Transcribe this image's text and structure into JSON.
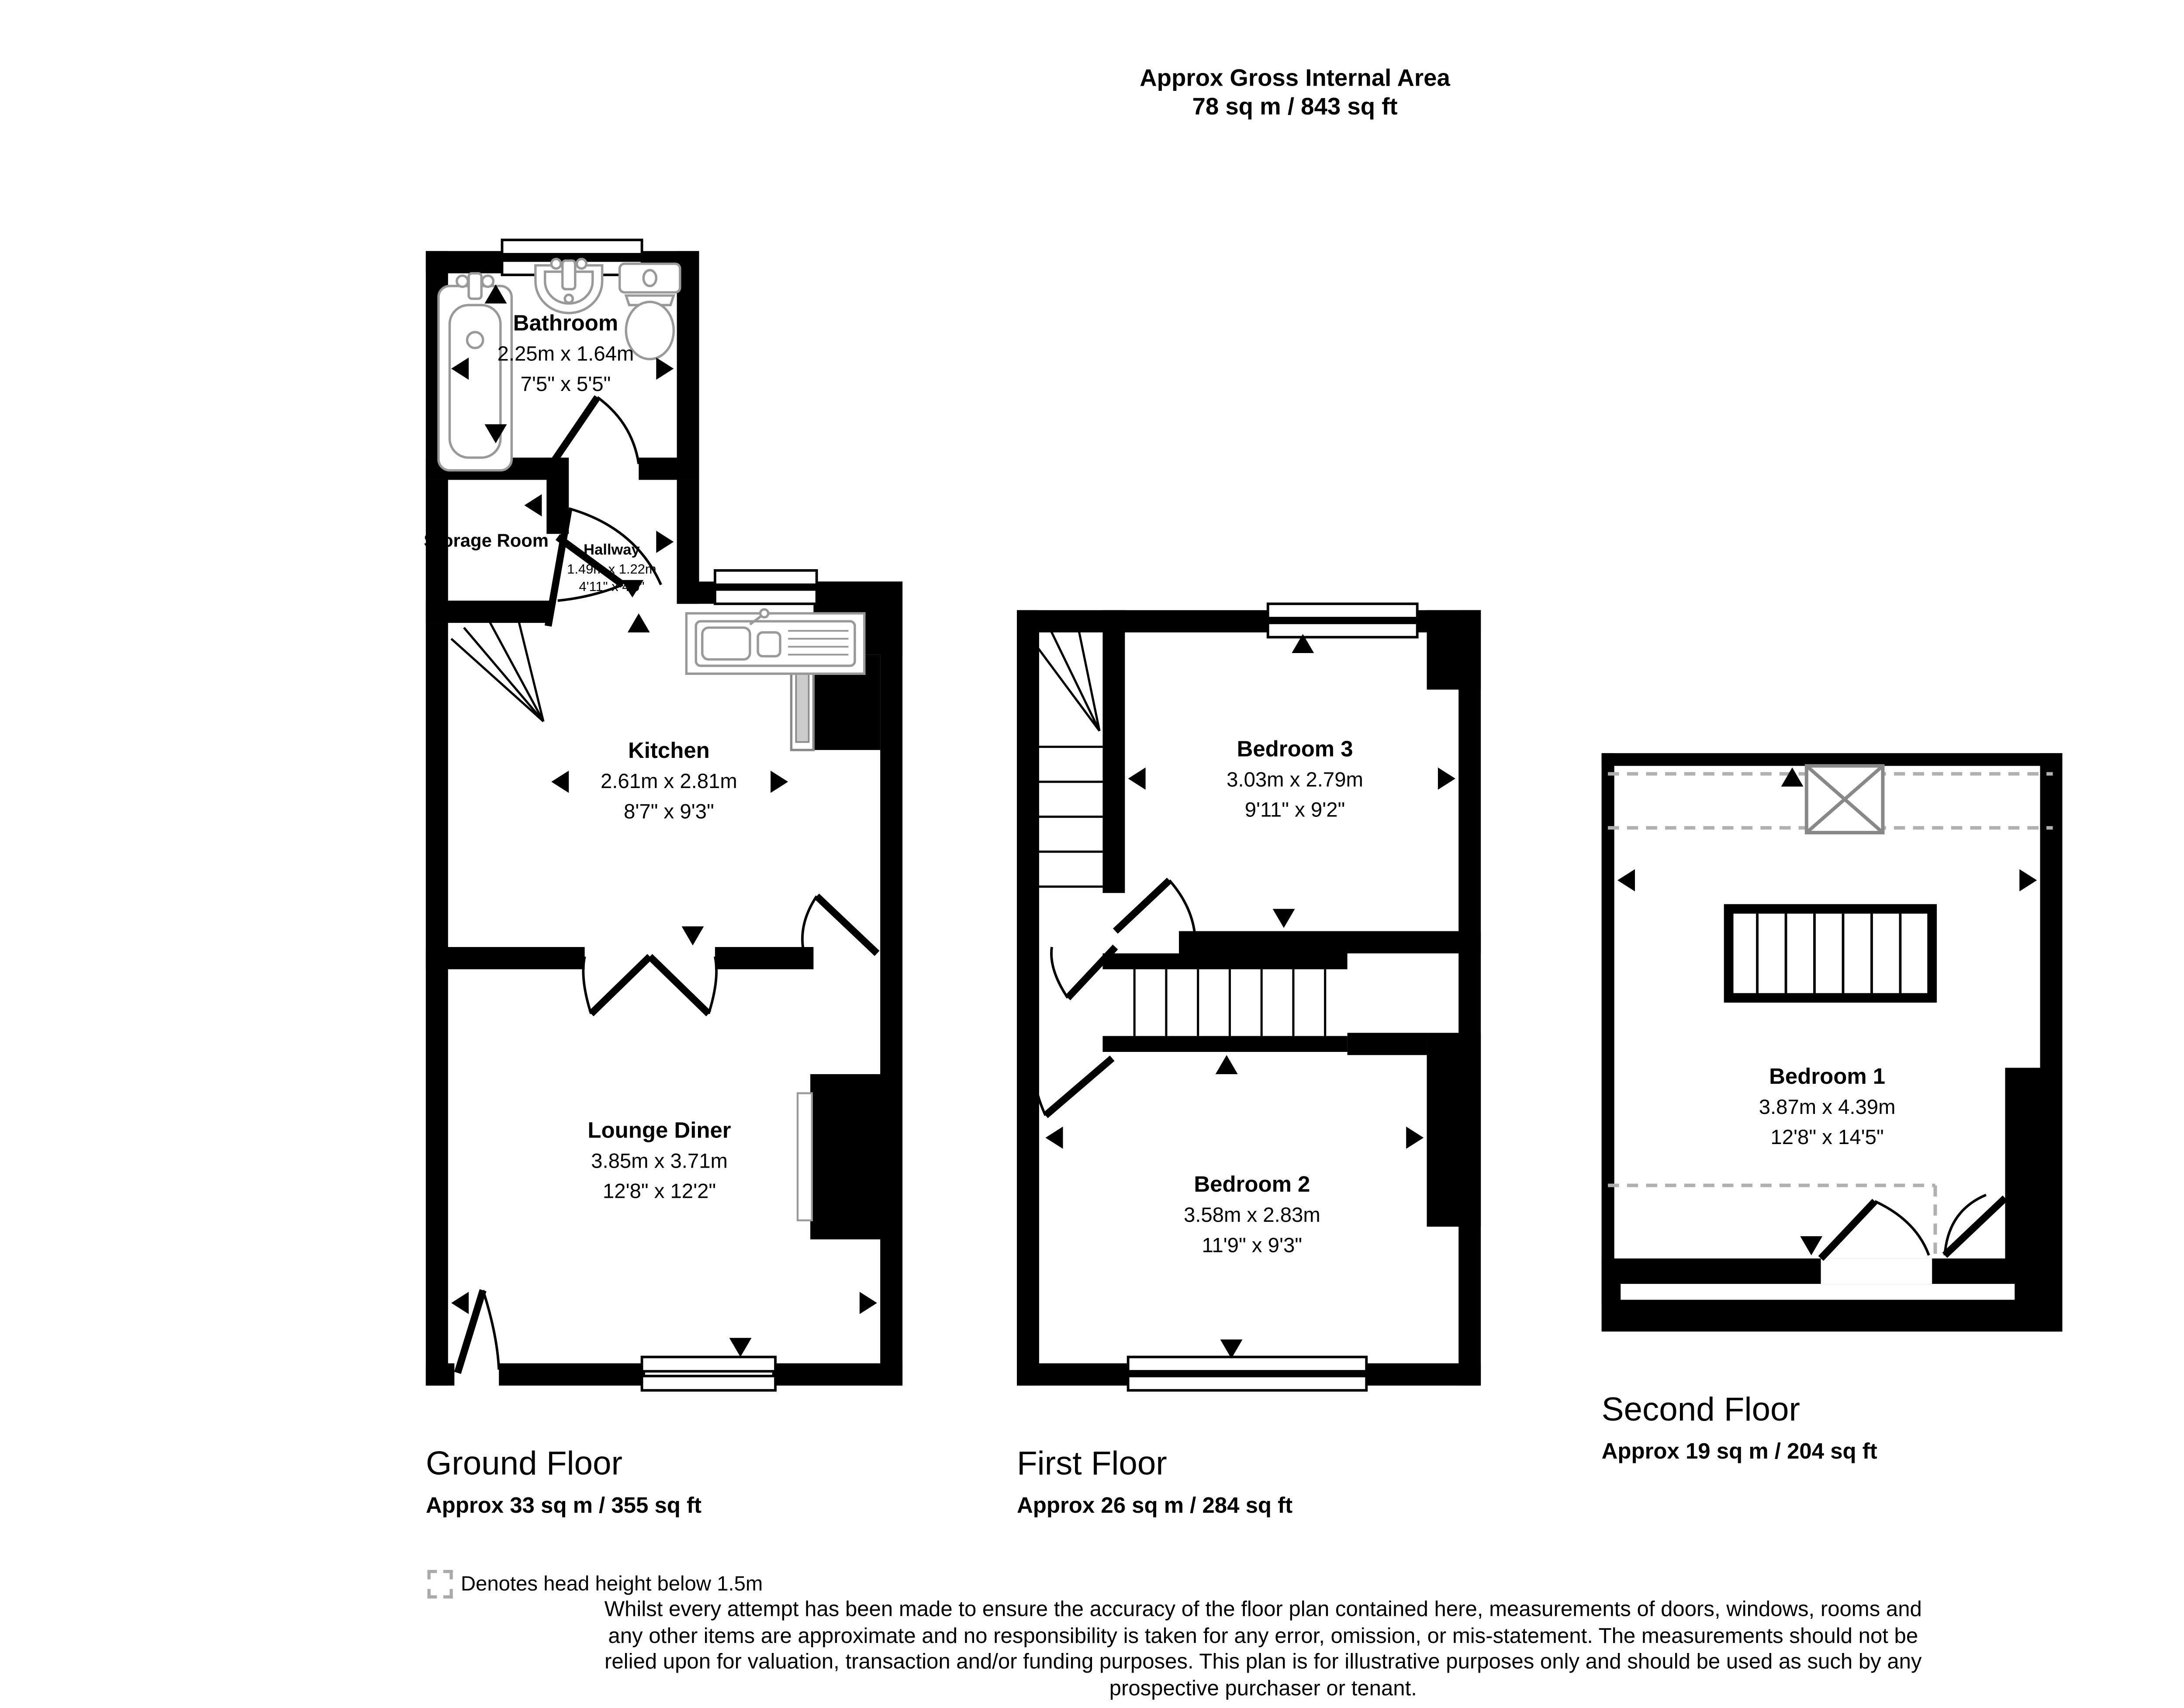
{
  "header": {
    "title": "Approx Gross Internal Area",
    "area_total": "78 sq m / 843 sq ft"
  },
  "compass": {
    "north": "N",
    "south": "S",
    "east": "E",
    "west": "W"
  },
  "ground_floor": {
    "label": "Ground Floor",
    "area": "Approx 33 sq m / 355 sq ft",
    "rooms": {
      "bathroom": {
        "name": "Bathroom",
        "metric": "2.25m x 1.64m",
        "imperial": "7'5\" x 5'5\""
      },
      "storage": {
        "name": "Storage Room"
      },
      "hallway": {
        "name": "Hallway",
        "metric": "1.49m x 1.22m",
        "imperial": "4'11\" x 4'0\""
      },
      "kitchen": {
        "name": "Kitchen",
        "metric": "2.61m x 2.81m",
        "imperial": "8'7\" x 9'3\""
      },
      "lounge": {
        "name": "Lounge Diner",
        "metric": "3.85m x 3.71m",
        "imperial": "12'8\" x 12'2\""
      }
    }
  },
  "first_floor": {
    "label": "First Floor",
    "area": "Approx 26 sq m / 284 sq ft",
    "rooms": {
      "bedroom3": {
        "name": "Bedroom 3",
        "metric": "3.03m x 2.79m",
        "imperial": "9'11\" x 9'2\""
      },
      "bedroom2": {
        "name": "Bedroom 2",
        "metric": "3.58m x 2.83m",
        "imperial": "11'9\" x 9'3\""
      }
    }
  },
  "second_floor": {
    "label": "Second Floor",
    "area": "Approx 19 sq m / 204 sq ft",
    "rooms": {
      "bedroom1": {
        "name": "Bedroom 1",
        "metric": "3.87m x 4.39m",
        "imperial": "12'8\" x 14'5\""
      }
    }
  },
  "legend": {
    "head_height_note": "Denotes head height below 1.5m"
  },
  "disclaimer": {
    "line1": "Whilst every attempt has been made to ensure the accuracy of the floor plan contained here, measurements of doors, windows, rooms and",
    "line2": "any other items are approximate and no responsibility is taken for any error, omission, or mis-statement. The measurements should not be",
    "line3": "relied upon for valuation, transaction and/or funding purposes. This plan is for illustrative purposes only and should be used as such by any",
    "line4": "prospective purchaser or tenant."
  }
}
